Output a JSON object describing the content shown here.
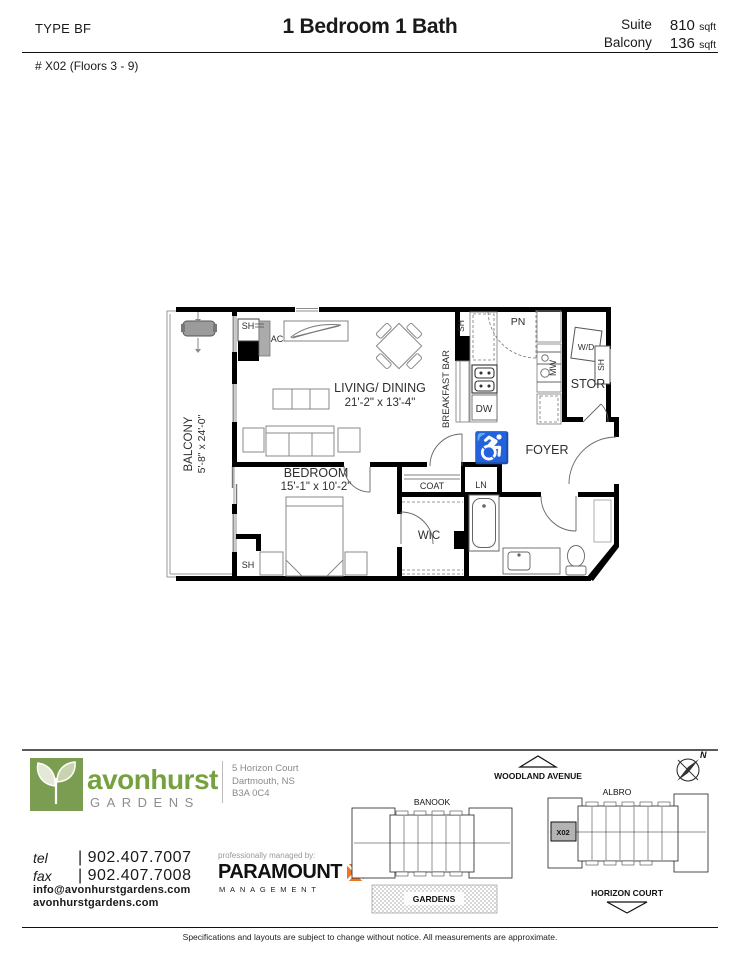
{
  "header": {
    "type": "TYPE BF",
    "title": "1 Bedroom 1 Bath",
    "suite_label": "Suite",
    "suite_value": "810",
    "balcony_label": "Balcony",
    "balcony_value": "136",
    "sqft": "sqft",
    "unit": "# X02 (Floors 3 - 9)"
  },
  "plan": {
    "balcony": "BALCONY",
    "balcony_dims": "5'-8\" x 24'-0\"",
    "living": "LIVING/ DINING",
    "living_dims": "21'-2\" x 13'-4\"",
    "bedroom": "BEDROOM",
    "bedroom_dims": "15'-1\" x 10'-2\"",
    "breakfast_bar": "BREAKFAST BAR",
    "foyer": "FOYER",
    "stor": "STOR",
    "wic": "WIC",
    "coat": "COAT",
    "ln": "LN",
    "pn": "PN",
    "dw": "DW",
    "mw": "MW",
    "wd": "W/D",
    "sh": "SH",
    "ac": "AC",
    "accessible_icon": "♿"
  },
  "sitemap": {
    "woodland": "WOODLAND AVENUE",
    "horizon": "HORIZON COURT",
    "banook": "BANOOK",
    "albro": "ALBRO",
    "unit": "X02",
    "gardens": "GARDENS",
    "north": "N"
  },
  "brand": {
    "name": "avonhurst",
    "sub": "GARDENS",
    "address1": "5 Horizon Court",
    "address2": "Dartmouth, NS",
    "address3": "B3A 0C4",
    "tel_label": "tel",
    "tel": "| 902.407.7007",
    "fax_label": "fax",
    "fax": "| 902.407.7008",
    "email": "info@avonhurstgardens.com",
    "web": "avonhurstgardens.com",
    "managed": "professionally managed by:",
    "manager": "PARAMOUNT",
    "manager_sub": "MANAGEMENT",
    "colors": {
      "green": "#76a13f",
      "logo_green": "#7b9d52",
      "orange": "#ee7523"
    }
  },
  "footer": {
    "disclaimer": "Specifications and layouts are subject to change without notice. All measurements are approximate."
  }
}
